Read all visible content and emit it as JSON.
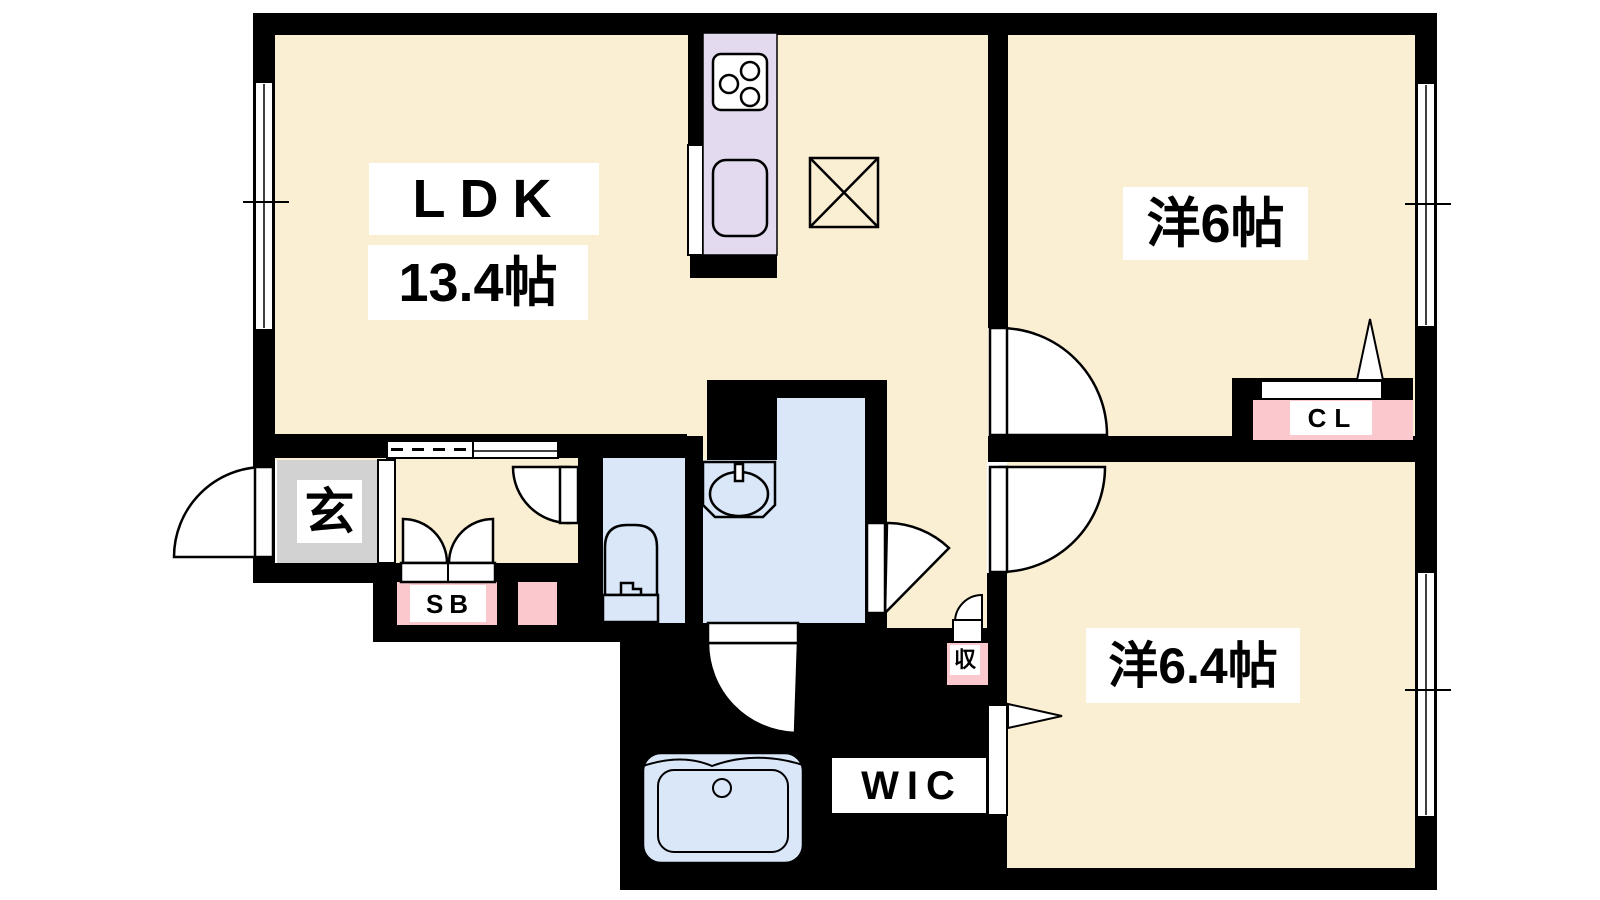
{
  "floorplan": {
    "type": "apartment-floorplan",
    "labels": {
      "ldk": "LDK",
      "ldk_size": "13.4帖",
      "west_room_6": "洋6帖",
      "west_room_64": "洋6.4帖",
      "wic": "WIC",
      "closet": "CL",
      "shoe_box": "SB",
      "entrance": "玄",
      "storage": "収"
    },
    "colors": {
      "floor": "#FBEFD3",
      "wet": "#D9E7F8",
      "kitchen": "#E4DAF0",
      "pink": "#FAC8CD",
      "gray": "#D2D2D2",
      "wall": "#000000",
      "paper": "#FFFFFF"
    }
  }
}
